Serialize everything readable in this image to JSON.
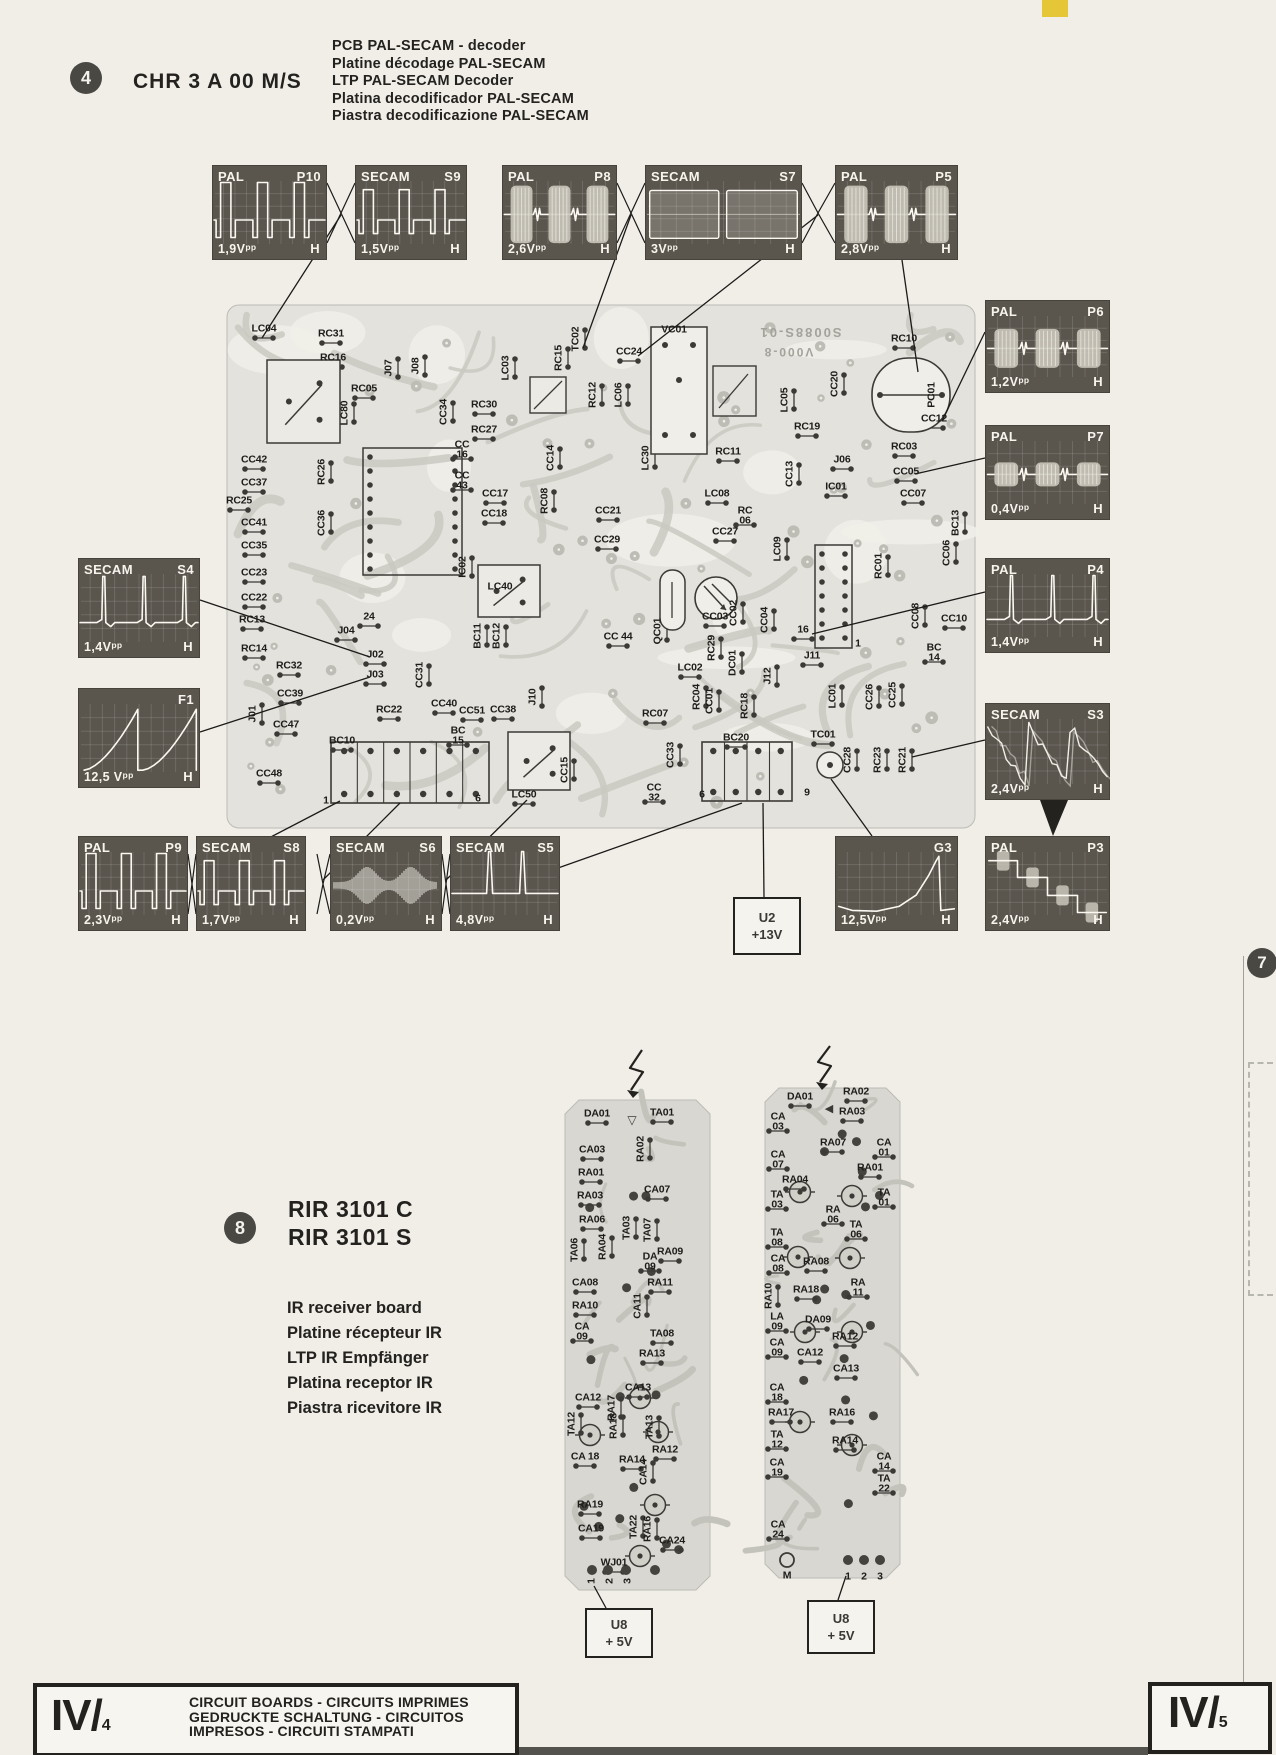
{
  "page": {
    "item_number": "4",
    "model": "CHR 3 A 00 M/S",
    "descriptions": [
      "PCB PAL-SECAM - decoder",
      "Platine décodage PAL-SECAM",
      "LTP PAL-SECAM Decoder",
      "Platina decodificador PAL-SECAM",
      "Piastra decodificazione PAL-SECAM"
    ],
    "side_page_marker": "7"
  },
  "colors": {
    "paper": "#f0eee7",
    "scope_bg": "#5a564e",
    "pcb_board": "#e3e2dc",
    "pcb_trace": "#c9c8c1",
    "ir_board": "#d8d7d1",
    "ink": "#23221f",
    "corner_tab": "#e5c636",
    "waveform": "#faf8f1"
  },
  "scopes": [
    {
      "system": "PAL",
      "code": "P10",
      "vpp": "1,9Vpp",
      "h": "H",
      "wave": "square",
      "x": 212,
      "y": 165,
      "w": 115,
      "hh": 95
    },
    {
      "system": "SECAM",
      "code": "S9",
      "vpp": "1,5Vpp",
      "h": "H",
      "wave": "square2",
      "x": 355,
      "y": 165,
      "w": 112,
      "hh": 95
    },
    {
      "system": "PAL",
      "code": "P8",
      "vpp": "2,6Vpp",
      "h": "H",
      "wave": "burst-lg",
      "x": 502,
      "y": 165,
      "w": 115,
      "hh": 95
    },
    {
      "system": "SECAM",
      "code": "S7",
      "vpp": "3Vpp",
      "h": "H",
      "wave": "bars",
      "x": 645,
      "y": 165,
      "w": 157,
      "hh": 95
    },
    {
      "system": "PAL",
      "code": "P5",
      "vpp": "2,8Vpp",
      "h": "H",
      "wave": "burst-lg",
      "x": 835,
      "y": 165,
      "w": 123,
      "hh": 95
    },
    {
      "system": "PAL",
      "code": "P6",
      "vpp": "1,2Vpp",
      "h": "H",
      "wave": "burst-md",
      "x": 985,
      "y": 300,
      "w": 125,
      "hh": 93
    },
    {
      "system": "PAL",
      "code": "P7",
      "vpp": "0,4Vpp",
      "h": "H",
      "wave": "burst-sm",
      "x": 985,
      "y": 425,
      "w": 125,
      "hh": 95
    },
    {
      "system": "PAL",
      "code": "P4",
      "vpp": "1,4Vpp",
      "h": "H",
      "wave": "pulses",
      "x": 985,
      "y": 558,
      "w": 125,
      "hh": 95
    },
    {
      "system": "SECAM",
      "code": "S3",
      "vpp": "2,4Vpp",
      "h": "H",
      "wave": "noisysaw",
      "x": 985,
      "y": 703,
      "w": 125,
      "hh": 97
    },
    {
      "system": "SECAM",
      "code": "S4",
      "vpp": "1,4Vpp",
      "h": "H",
      "wave": "pulses",
      "x": 78,
      "y": 558,
      "w": 122,
      "hh": 100
    },
    {
      "system": "",
      "code": "F1",
      "vpp": "12,5 Vpp",
      "h": "H",
      "wave": "saw",
      "x": 78,
      "y": 688,
      "w": 122,
      "hh": 100
    },
    {
      "system": "PAL",
      "code": "P9",
      "vpp": "2,3Vpp",
      "h": "H",
      "wave": "square",
      "x": 78,
      "y": 836,
      "w": 110,
      "hh": 95
    },
    {
      "system": "SECAM",
      "code": "S8",
      "vpp": "1,7Vpp",
      "h": "H",
      "wave": "square2",
      "x": 196,
      "y": 836,
      "w": 110,
      "hh": 95
    },
    {
      "system": "SECAM",
      "code": "S6",
      "vpp": "0,2Vpp",
      "h": "H",
      "wave": "noise",
      "x": 330,
      "y": 836,
      "w": 112,
      "hh": 95
    },
    {
      "system": "SECAM",
      "code": "S5",
      "vpp": "4,8Vpp",
      "h": "H",
      "wave": "spikes",
      "x": 450,
      "y": 836,
      "w": 110,
      "hh": 95
    },
    {
      "system": "",
      "code": "G3",
      "vpp": "12,5Vpp",
      "h": "H",
      "wave": "ramp",
      "x": 835,
      "y": 836,
      "w": 123,
      "hh": 95
    },
    {
      "system": "PAL",
      "code": "P3",
      "vpp": "2,4Vpp",
      "h": "H",
      "wave": "stairs",
      "x": 985,
      "y": 836,
      "w": 125,
      "hh": 95
    }
  ],
  "pcb": {
    "print_line1": "S0088S-01",
    "print_line2": "V000-8",
    "labels": [
      [
        "LC04",
        264,
        329,
        0
      ],
      [
        "RC31",
        331,
        334,
        0
      ],
      [
        "RC16",
        333,
        358,
        0
      ],
      [
        "J07",
        389,
        368,
        1
      ],
      [
        "J08",
        416,
        366,
        1
      ],
      [
        "LC03",
        506,
        368,
        1
      ],
      [
        "TC02",
        576,
        339,
        1
      ],
      [
        "RC15",
        559,
        358,
        1
      ],
      [
        "CC24",
        629,
        352,
        0
      ],
      [
        "VC01",
        674,
        330,
        0
      ],
      [
        "RC10",
        904,
        339,
        0
      ],
      [
        "RC05",
        364,
        389,
        0
      ],
      [
        "LC80",
        345,
        413,
        1
      ],
      [
        "CC34",
        444,
        412,
        1
      ],
      [
        "RC30",
        484,
        405,
        0
      ],
      [
        "RC27",
        484,
        430,
        0
      ],
      [
        "RC12",
        593,
        395,
        1
      ],
      [
        "LC06",
        619,
        395,
        1
      ],
      [
        "LC05",
        785,
        400,
        1
      ],
      [
        "CC20",
        835,
        384,
        1
      ],
      [
        "PC01",
        932,
        395,
        1
      ],
      [
        "CC12",
        934,
        419,
        0
      ],
      [
        "RC03",
        904,
        447,
        0
      ],
      [
        "CC05",
        906,
        472,
        0
      ],
      [
        "RC19",
        807,
        427,
        0
      ],
      [
        "CC42",
        254,
        460,
        0
      ],
      [
        "CC37",
        254,
        483,
        0
      ],
      [
        "RC26",
        322,
        472,
        1
      ],
      [
        "CC\n16",
        462,
        450,
        0
      ],
      [
        "CC\n43",
        462,
        481,
        0
      ],
      [
        "CC17",
        495,
        494,
        0
      ],
      [
        "CC18",
        494,
        514,
        0
      ],
      [
        "CC14",
        551,
        458,
        1
      ],
      [
        "RC08",
        545,
        501,
        1
      ],
      [
        "LC30",
        646,
        458,
        1
      ],
      [
        "RC11",
        728,
        452,
        0
      ],
      [
        "CC13",
        790,
        474,
        1
      ],
      [
        "J06",
        842,
        460,
        0
      ],
      [
        "IC01",
        836,
        487,
        0
      ],
      [
        "CC07",
        913,
        494,
        0
      ],
      [
        "RC25",
        239,
        501,
        0
      ],
      [
        "CC41",
        254,
        523,
        0
      ],
      [
        "CC36",
        322,
        523,
        1
      ],
      [
        "CC35",
        254,
        546,
        0
      ],
      [
        "CC21",
        608,
        511,
        0
      ],
      [
        "CC29",
        607,
        540,
        0
      ],
      [
        "LC08",
        717,
        494,
        0
      ],
      [
        "RC\n06",
        745,
        516,
        0
      ],
      [
        "CC27",
        725,
        532,
        0
      ],
      [
        "LC09",
        778,
        549,
        1
      ],
      [
        "BC13",
        956,
        523,
        1
      ],
      [
        "CC06",
        947,
        553,
        1
      ],
      [
        "RC01",
        879,
        566,
        1
      ],
      [
        "CC23",
        254,
        573,
        0
      ],
      [
        "CC22",
        254,
        598,
        0
      ],
      [
        "RC13",
        252,
        620,
        0
      ],
      [
        "IC02",
        463,
        567,
        1
      ],
      [
        "LC40",
        500,
        587,
        0
      ],
      [
        "CC08",
        916,
        616,
        1
      ],
      [
        "CC10",
        954,
        619,
        0
      ],
      [
        "BC\n14",
        934,
        653,
        0
      ],
      [
        "QC01",
        658,
        631,
        1
      ],
      [
        "CC03",
        715,
        617,
        0
      ],
      [
        "CC02",
        734,
        613,
        1
      ],
      [
        "CC04",
        765,
        620,
        1
      ],
      [
        "CC 44",
        618,
        637,
        0
      ],
      [
        "RC29",
        712,
        648,
        1
      ],
      [
        "DC01",
        733,
        663,
        1
      ],
      [
        "LC02",
        690,
        668,
        0
      ],
      [
        "J04",
        346,
        631,
        0
      ],
      [
        "24",
        369,
        617,
        0
      ],
      [
        "RC14",
        254,
        649,
        0
      ],
      [
        "BC11",
        478,
        636,
        1
      ],
      [
        "BC12",
        497,
        636,
        1
      ],
      [
        "J11",
        812,
        656,
        0
      ],
      [
        "16",
        803,
        630,
        0
      ],
      [
        "1",
        858,
        644,
        0
      ],
      [
        "RC32",
        289,
        666,
        0
      ],
      [
        "J02",
        375,
        655,
        0
      ],
      [
        "J03",
        375,
        675,
        0
      ],
      [
        "CC31",
        420,
        675,
        1
      ],
      [
        "CC39",
        290,
        694,
        0
      ],
      [
        "RC22",
        389,
        710,
        0
      ],
      [
        "CC40",
        444,
        704,
        0
      ],
      [
        "CC51",
        472,
        711,
        0
      ],
      [
        "CC38",
        503,
        710,
        0
      ],
      [
        "J10",
        533,
        697,
        1
      ],
      [
        "CC47",
        286,
        725,
        0
      ],
      [
        "J01",
        253,
        714,
        1
      ],
      [
        "J12",
        768,
        676,
        1
      ],
      [
        "RC07",
        655,
        714,
        0
      ],
      [
        "RC04",
        697,
        697,
        1
      ],
      [
        "CC01",
        710,
        701,
        1
      ],
      [
        "RC18",
        745,
        706,
        1
      ],
      [
        "LC01",
        833,
        696,
        1
      ],
      [
        "CC26",
        870,
        697,
        1
      ],
      [
        "CC25",
        893,
        695,
        1
      ],
      [
        "BC10",
        342,
        741,
        0
      ],
      [
        "BC\n15",
        458,
        736,
        0
      ],
      [
        "CC48",
        269,
        774,
        0
      ],
      [
        "1",
        326,
        801,
        0
      ],
      [
        "6",
        478,
        799,
        0
      ],
      [
        "LC50",
        524,
        795,
        0
      ],
      [
        "CC15",
        565,
        770,
        1
      ],
      [
        "CC33",
        671,
        755,
        1
      ],
      [
        "CC\n32",
        654,
        793,
        0
      ],
      [
        "BC20",
        736,
        738,
        0
      ],
      [
        "TC01",
        823,
        735,
        0
      ],
      [
        "CC28",
        848,
        760,
        1
      ],
      [
        "RC23",
        878,
        760,
        1
      ],
      [
        "RC21",
        903,
        760,
        1
      ],
      [
        "6",
        702,
        795,
        0
      ],
      [
        "9",
        807,
        793,
        0
      ]
    ]
  },
  "supply_boxes": [
    {
      "lines": [
        "U2",
        "+13V"
      ],
      "x": 733,
      "y": 897,
      "w": 64,
      "h": 54
    },
    {
      "lines": [
        "U8",
        "+ 5V"
      ],
      "x": 585,
      "y": 1608,
      "w": 64,
      "h": 46
    },
    {
      "lines": [
        "U8",
        "+ 5V"
      ],
      "x": 807,
      "y": 1600,
      "w": 64,
      "h": 50
    }
  ],
  "ir_section": {
    "item_number": "8",
    "titles": [
      "RIR 3101 C",
      "RIR 3101 S"
    ],
    "descriptions": [
      "IR receiver board",
      "Platine récepteur IR",
      "LTP IR Empfänger",
      "Platina receptor IR",
      "Piastra ricevitore IR"
    ]
  },
  "ir_boards": {
    "left_labels": [
      [
        "DA01",
        597,
        1114,
        0
      ],
      [
        "TA01",
        662,
        1113,
        0
      ],
      [
        "CA03",
        592,
        1150,
        0
      ],
      [
        "RA02",
        641,
        1149,
        1
      ],
      [
        "RA01",
        591,
        1173,
        0
      ],
      [
        "RA03",
        590,
        1196,
        0
      ],
      [
        "CA07",
        657,
        1190,
        0
      ],
      [
        "RA06",
        592,
        1220,
        0
      ],
      [
        "TA06",
        575,
        1250,
        1
      ],
      [
        "RA04",
        603,
        1247,
        1
      ],
      [
        "TA03",
        627,
        1228,
        1
      ],
      [
        "TA07",
        648,
        1230,
        1
      ],
      [
        "DA\n09",
        650,
        1262,
        0
      ],
      [
        "RA09",
        670,
        1252,
        0
      ],
      [
        "CA08",
        585,
        1283,
        0
      ],
      [
        "RA11",
        660,
        1283,
        0
      ],
      [
        "RA10",
        585,
        1306,
        0
      ],
      [
        "CA11",
        638,
        1306,
        1
      ],
      [
        "CA\n09",
        582,
        1332,
        0
      ],
      [
        "TA08",
        662,
        1334,
        0
      ],
      [
        "RA13",
        652,
        1354,
        0
      ],
      [
        "CA13",
        638,
        1388,
        0
      ],
      [
        "CA12",
        588,
        1398,
        0
      ],
      [
        "RA17",
        612,
        1408,
        1
      ],
      [
        "TA12",
        572,
        1424,
        1
      ],
      [
        "RA18",
        614,
        1426,
        1
      ],
      [
        "TA13",
        650,
        1427,
        1
      ],
      [
        "RA12",
        665,
        1450,
        0
      ],
      [
        "CA 18",
        585,
        1457,
        0
      ],
      [
        "RA14",
        632,
        1460,
        0
      ],
      [
        "CA14",
        644,
        1472,
        1
      ],
      [
        "RA19",
        590,
        1505,
        0
      ],
      [
        "CA19",
        591,
        1529,
        0
      ],
      [
        "TA22",
        634,
        1527,
        1
      ],
      [
        "RA16",
        648,
        1529,
        1
      ],
      [
        "CA24",
        672,
        1541,
        0
      ],
      [
        "WJ01",
        614,
        1563,
        0
      ],
      [
        "1",
        592,
        1581,
        1
      ],
      [
        "2",
        610,
        1581,
        1
      ],
      [
        "3",
        628,
        1581,
        1
      ]
    ],
    "right_labels": [
      [
        "DA01",
        800,
        1097,
        0
      ],
      [
        "RA02",
        856,
        1092,
        0
      ],
      [
        "RA03",
        852,
        1112,
        0
      ],
      [
        "CA\n03",
        778,
        1122,
        0
      ],
      [
        "RA07",
        833,
        1143,
        0
      ],
      [
        "CA\n07",
        778,
        1160,
        0
      ],
      [
        "CA\n01",
        884,
        1148,
        0
      ],
      [
        "RA01",
        870,
        1168,
        0
      ],
      [
        "RA04",
        795,
        1180,
        0
      ],
      [
        "TA\n03",
        777,
        1200,
        0
      ],
      [
        "TA\n01",
        884,
        1198,
        0
      ],
      [
        "RA\n06",
        833,
        1215,
        0
      ],
      [
        "TA\n06",
        856,
        1230,
        0
      ],
      [
        "TA\n08",
        777,
        1238,
        0
      ],
      [
        "CA\n08",
        778,
        1264,
        0
      ],
      [
        "RA08",
        816,
        1262,
        0
      ],
      [
        "RA\n11",
        858,
        1288,
        0
      ],
      [
        "RA18",
        806,
        1290,
        0
      ],
      [
        "RA10",
        769,
        1296,
        1
      ],
      [
        "LA\n09",
        777,
        1322,
        0
      ],
      [
        "DA09",
        818,
        1320,
        0
      ],
      [
        "CA\n09",
        777,
        1348,
        0
      ],
      [
        "RA12",
        845,
        1337,
        0
      ],
      [
        "CA12",
        810,
        1353,
        0
      ],
      [
        "CA13",
        846,
        1369,
        0
      ],
      [
        "CA\n18",
        777,
        1393,
        0
      ],
      [
        "RA17",
        781,
        1413,
        0
      ],
      [
        "RA16",
        842,
        1413,
        0
      ],
      [
        "TA\n12",
        777,
        1440,
        0
      ],
      [
        "RA14",
        845,
        1441,
        0
      ],
      [
        "CA\n19",
        777,
        1468,
        0
      ],
      [
        "CA\n14",
        884,
        1462,
        0
      ],
      [
        "TA\n22",
        884,
        1484,
        0
      ],
      [
        "CA\n24",
        778,
        1530,
        0
      ],
      [
        "M",
        787,
        1576,
        0
      ],
      [
        "1",
        848,
        1577,
        0
      ],
      [
        "2",
        864,
        1577,
        0
      ],
      [
        "3",
        880,
        1577,
        0
      ]
    ]
  },
  "footer": {
    "page_left": "IV/",
    "page_left_sub": "4",
    "page_right": "IV/",
    "page_right_sub": "5",
    "lines": [
      "CIRCUIT BOARDS - CIRCUITS IMPRIMES",
      "GEDRUCKTE SCHALTUNG - CIRCUITOS",
      "IMPRESOS - CIRCUITI STAMPATI"
    ]
  }
}
